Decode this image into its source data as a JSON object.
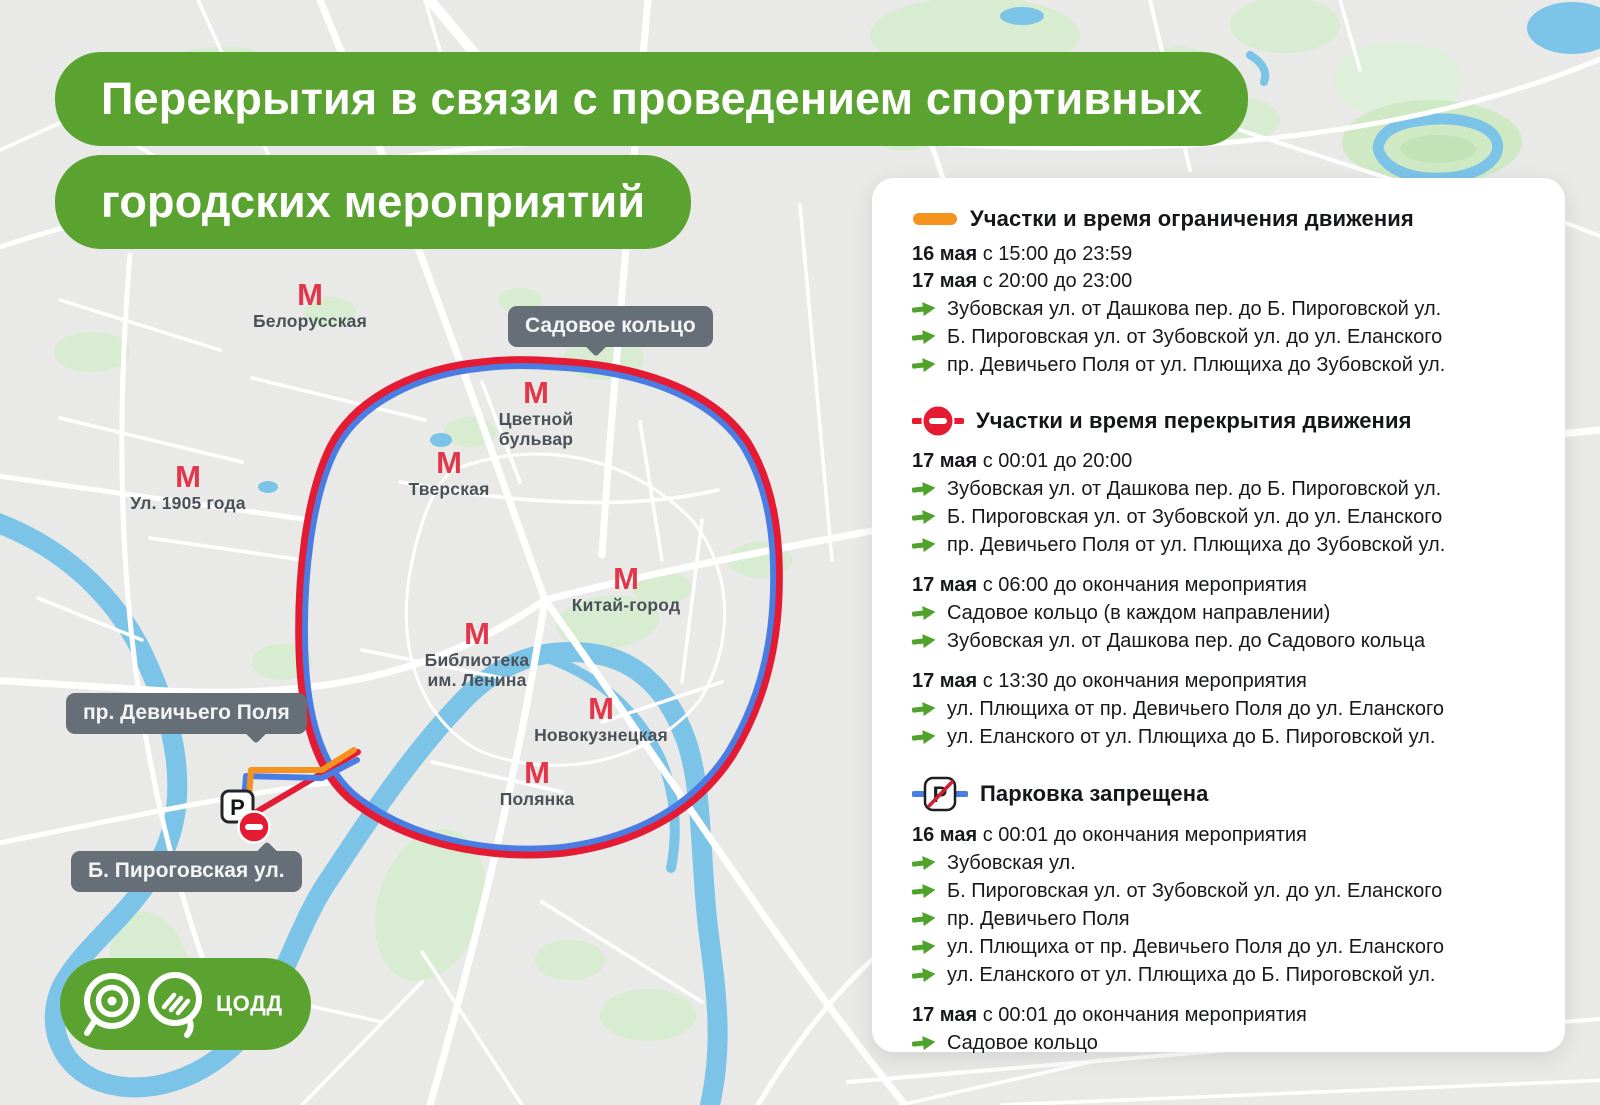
{
  "header": {
    "line1": "Перекрытия в связи с проведением спортивных",
    "line2": "городских мероприятий"
  },
  "logo": {
    "text": "ЦОДД"
  },
  "map": {
    "metro_symbol": "М",
    "stations": [
      {
        "name": "Белорусская",
        "x": 310,
        "y": 282,
        "label": "Белорусская"
      },
      {
        "name": "Ул. 1905 года",
        "x": 188,
        "y": 464,
        "label": "Ул. 1905 года"
      },
      {
        "name": "Цветной бульвар",
        "x": 536,
        "y": 380,
        "label": "Цветной\nбульвар"
      },
      {
        "name": "Тверская",
        "x": 449,
        "y": 450,
        "label": "Тверская"
      },
      {
        "name": "Китай-город",
        "x": 626,
        "y": 566,
        "label": "Китай-город"
      },
      {
        "name": "Библиотека им. Ленина",
        "x": 477,
        "y": 621,
        "label": "Библиотека\nим. Ленина"
      },
      {
        "name": "Новокузнецкая",
        "x": 601,
        "y": 696,
        "label": "Новокузнецкая"
      },
      {
        "name": "Полянка",
        "x": 537,
        "y": 760,
        "label": "Полянка"
      }
    ],
    "bubbles": [
      {
        "text": "Садовое кольцо",
        "x": 508,
        "y": 306,
        "dir": "down",
        "px": 88
      },
      {
        "text": "пр. Девичьего Поля",
        "x": 66,
        "y": 693,
        "dir": "down",
        "px": 190
      },
      {
        "text": "Б. Пироговская ул.",
        "x": 71,
        "y": 851,
        "dir": "up",
        "px": 196
      }
    ],
    "parking_sign_letter": "P"
  },
  "panel": {
    "sections": [
      {
        "icon": "restricted-line",
        "title": "Участки и время ограничения движения",
        "groups": [
          {
            "dates": [
              {
                "bold": "16 мая",
                "rest": " с 15:00 до 23:59"
              },
              {
                "bold": "17 мая",
                "rest": " с 20:00 до 23:00"
              }
            ],
            "items": [
              "Зубовская ул. от Дашкова пер. до Б. Пироговской ул.",
              "Б. Пироговская ул. от Зубовской ул. до ул. Еланского",
              "пр. Девичьего Поля от ул. Плющиха до Зубовской ул."
            ]
          }
        ]
      },
      {
        "icon": "no-entry",
        "title": "Участки и время перекрытия движения",
        "groups": [
          {
            "dates": [
              {
                "bold": "17 мая",
                "rest": " с 00:01 до 20:00"
              }
            ],
            "items": [
              "Зубовская ул. от Дашкова пер. до Б. Пироговской ул.",
              "Б. Пироговская ул. от Зубовской ул. до ул. Еланского",
              "пр. Девичьего Поля от ул. Плющиха до Зубовской ул."
            ]
          },
          {
            "dates": [
              {
                "bold": "17 мая",
                "rest": " с 06:00 до окончания мероприятия"
              }
            ],
            "items": [
              "Садовое кольцо (в каждом направлении)",
              "Зубовская ул. от Дашкова пер. до Садового кольца"
            ]
          },
          {
            "dates": [
              {
                "bold": "17 мая",
                "rest": " с 13:30 до окончания мероприятия"
              }
            ],
            "items": [
              "ул. Плющиха от пр. Девичьего Поля до ул. Еланского",
              "ул. Еланского от ул. Плющиха до Б. Пироговской ул."
            ]
          }
        ]
      },
      {
        "icon": "no-parking",
        "title": "Парковка запрещена",
        "groups": [
          {
            "dates": [
              {
                "bold": "16 мая",
                "rest": " с 00:01 до окончания мероприятия"
              }
            ],
            "items": [
              "Зубовская ул.",
              "Б. Пироговская ул. от Зубовской ул. до ул. Еланского",
              "пр. Девичьего Поля",
              "ул. Плющиха от пр. Девичьего Поля до ул. Еланского",
              "ул. Еланского от ул. Плющиха до Б. Пироговской ул."
            ]
          },
          {
            "dates": [
              {
                "bold": "17 мая",
                "rest": " с 00:01 до окончания мероприятия"
              }
            ],
            "items": [
              "Садовое кольцо"
            ]
          }
        ]
      }
    ]
  },
  "colors": {
    "green": "#5ba331",
    "ring_red": "#e41b33",
    "ring_blue": "#4a7de4",
    "orange": "#f6921e",
    "metro_red": "#e2364a",
    "arrow_green": "#4fa32a",
    "water": "#7cc3e8",
    "park": "#d7ecd0",
    "bubble": "#666e77"
  }
}
